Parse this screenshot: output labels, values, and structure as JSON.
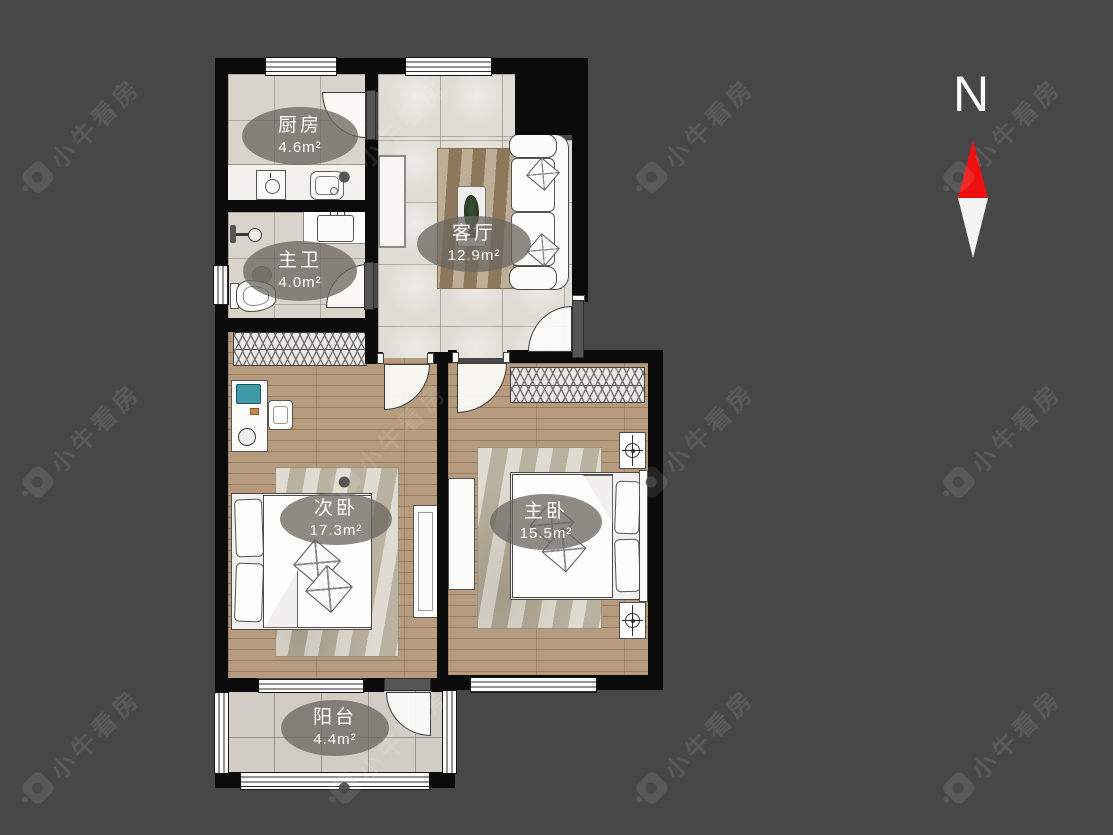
{
  "brand": {
    "watermark_text": "小牛看房"
  },
  "compass": {
    "label": "N"
  },
  "rooms": [
    {
      "id": "kitchen",
      "name": "厨房",
      "area": "4.6m²"
    },
    {
      "id": "master-bath",
      "name": "主卫",
      "area": "4.0m²"
    },
    {
      "id": "living-room",
      "name": "客厅",
      "area": "12.9m²"
    },
    {
      "id": "second-bedroom",
      "name": "次卧",
      "area": "17.3m²"
    },
    {
      "id": "master-bedroom",
      "name": "主卧",
      "area": "15.5m²"
    },
    {
      "id": "balcony",
      "name": "阳台",
      "area": "4.4m²"
    }
  ],
  "colors": {
    "background": "#474747",
    "wall": "#0b0b0b",
    "tile_floor": "#d8d4cb",
    "wood_floor": "#b69b7e",
    "label_background": "rgba(106,102,96,0.76)",
    "compass_needle_red": "#ee1010"
  }
}
